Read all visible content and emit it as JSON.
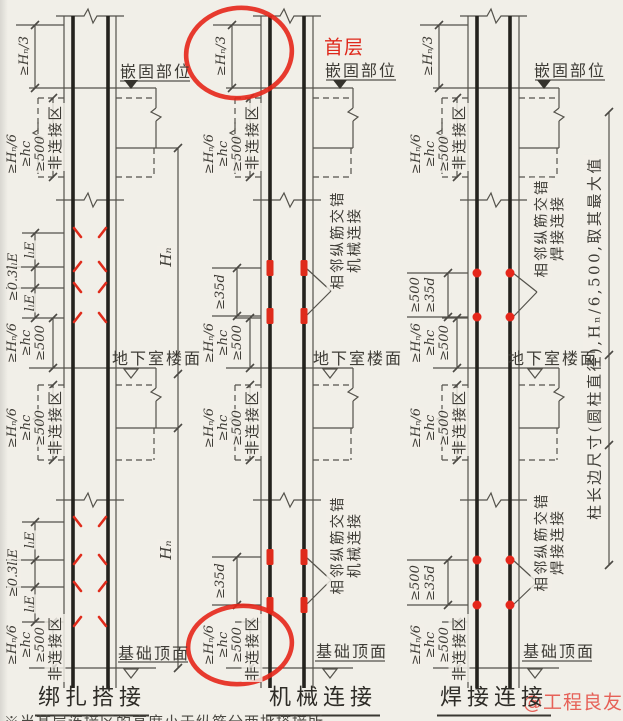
{
  "page": {
    "background": "#f1efe8",
    "line_color": "#54524b",
    "red_color": "#df281b"
  },
  "labels": {
    "embedment": "嵌固部位",
    "basement_floor": "地下室楼面",
    "foundation_top": "基础顶面",
    "non_connection_zone": "非连接区",
    "first_floor": "首层",
    "story_height": "Hₙ",
    "side_note": "柱长边尺寸(圆柱直径),Hₙ/6,500,取其最大值",
    "bottom_note": "※当某层连接区的高度小于纵筋分两批搭接所",
    "watermark": "@工程良友"
  },
  "dimensions": {
    "top_zone": "≥Hₙ/3",
    "hn_over_6": "≥Hₙ/6",
    "hc": "≥hc",
    "min_500": "≥500",
    "lap_length": "lₗE",
    "lap_stagger": "≥0.3lₗE",
    "stagger_35d": "≥35d"
  },
  "diagrams": [
    {
      "title": "绑扎搭接",
      "type": "lap-splice"
    },
    {
      "title": "机械连接",
      "type": "mechanical",
      "leader_line1": "相邻纵筋交错",
      "leader_line2": "机械连接"
    },
    {
      "title": "焊接连接",
      "type": "weld",
      "leader_line1": "相邻纵筋交错",
      "leader_line2": "焊接连接"
    }
  ]
}
